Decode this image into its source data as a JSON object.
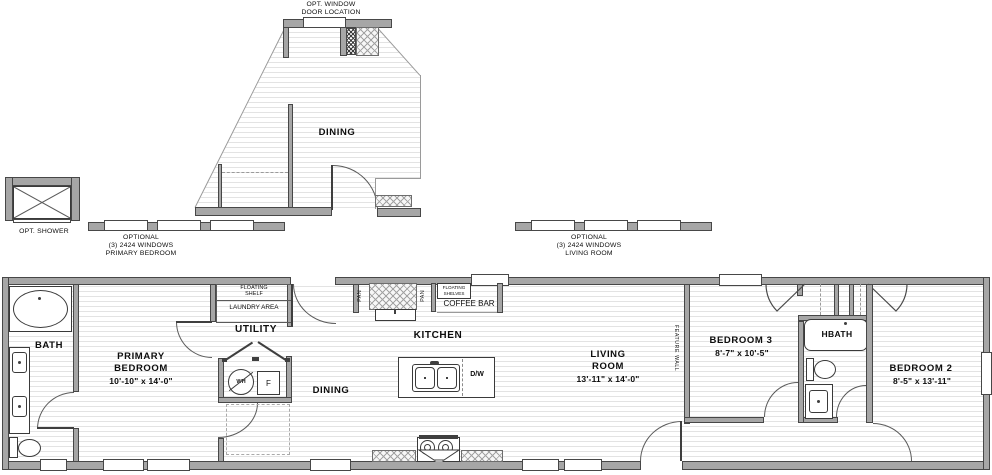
{
  "upper_detail": {
    "door_note_line1": "OPT. WINDOW",
    "door_note_line2": "DOOR LOCATION",
    "dining": "DINING",
    "shower_note": "OPT. SHOWER"
  },
  "window_notes": {
    "primary_bedroom": {
      "line1": "OPTIONAL",
      "line2": "(3) 2424 WINDOWS",
      "line3": "PRIMARY BEDROOM"
    },
    "living_room": {
      "line1": "OPTIONAL",
      "line2": "(3) 2424 WINDOWS",
      "line3": "LIVING ROOM"
    }
  },
  "rooms": {
    "bath": {
      "name": "BATH"
    },
    "primary_bedroom": {
      "name_line1": "PRIMARY",
      "name_line2": "BEDROOM",
      "dims": "10'-10\" x  14'-0\""
    },
    "utility": {
      "name": "UTILITY",
      "shelf_line1": "FLOATING",
      "shelf_line2": "SHELF",
      "laundry": "LAUNDRY AREA",
      "water_heater": "WH",
      "freezer": "F"
    },
    "dining": {
      "name": "DINING"
    },
    "kitchen": {
      "name": "KITCHEN",
      "pantry_left": "PAN",
      "pantry_right": "PAN",
      "shelves_line1": "FLOATING",
      "shelves_line2": "SHELVES",
      "coffee_bar": "COFFEE BAR",
      "dishwasher": "D/W"
    },
    "living_room": {
      "name_line1": "LIVING",
      "name_line2": "ROOM",
      "dims": "13'-11\" x  14'-0\"",
      "feature_wall": "FEATURE WALL"
    },
    "bedroom_3": {
      "name": "BEDROOM 3",
      "dims": "8'-7\" x  10'-5\""
    },
    "hbath": {
      "name": "HBATH"
    },
    "bedroom_2": {
      "name": "BEDROOM 2",
      "dims": "8'-5\" x  13'-11\""
    }
  }
}
